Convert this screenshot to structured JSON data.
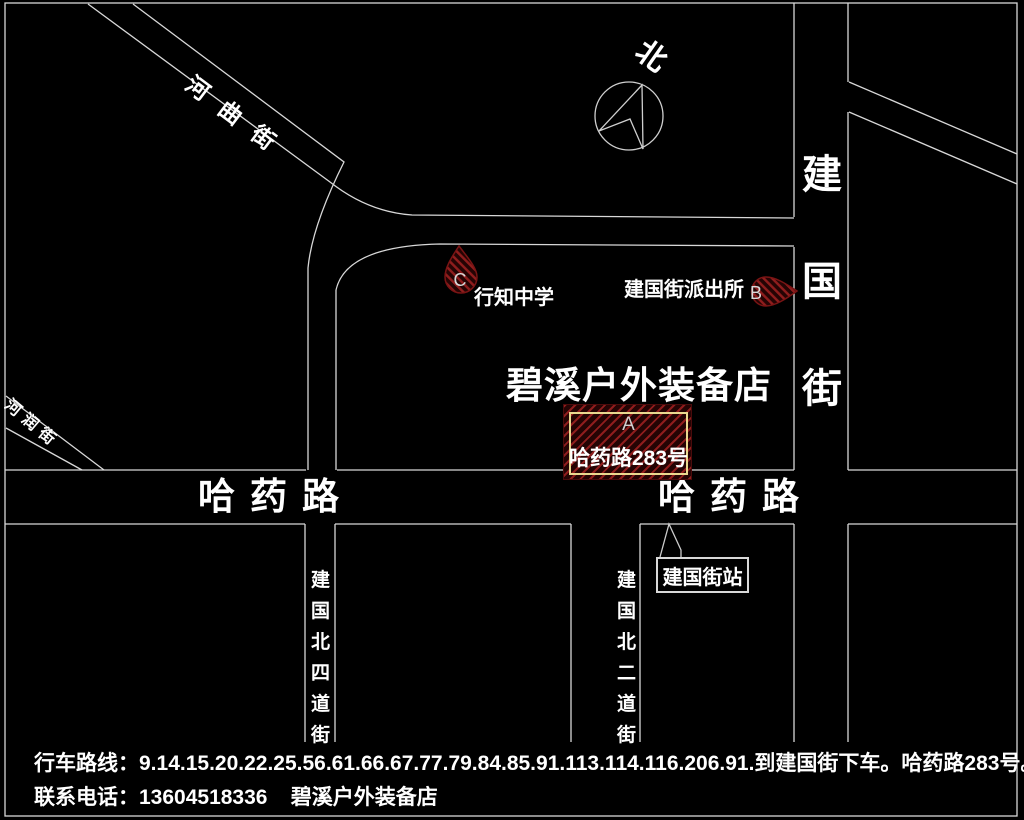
{
  "colors": {
    "background": "#000000",
    "road_line": "#d8d8d8",
    "text": "#ffffff",
    "hatch_red": "#8f1d1d",
    "hatch_dark": "#250404",
    "marker_box_border": "#e9d88f"
  },
  "compass": {
    "north_label": "北"
  },
  "streets": {
    "hequ": "河曲街",
    "herun": "河润街",
    "jianguo": "建国街",
    "hayao_left": "哈药路",
    "hayao_right": "哈药路",
    "jianguo_bei_si": "建国北四道街",
    "jianguo_bei_er": "建国北二道街"
  },
  "pois": {
    "school": {
      "marker": "C",
      "name": "行知中学"
    },
    "police": {
      "marker": "B",
      "name": "建国街派出所"
    },
    "store": {
      "marker": "A",
      "title": "碧溪户外装备店",
      "address": "哈药路283号"
    },
    "station": {
      "name": "建国街站"
    }
  },
  "footer": {
    "route_line": "行车路线：9.14.15.20.22.25.56.61.66.67.77.79.84.85.91.113.114.116.206.91.到建国街下车。哈药路283号。",
    "contact_line": "联系电话：13604518336    碧溪户外装备店"
  }
}
